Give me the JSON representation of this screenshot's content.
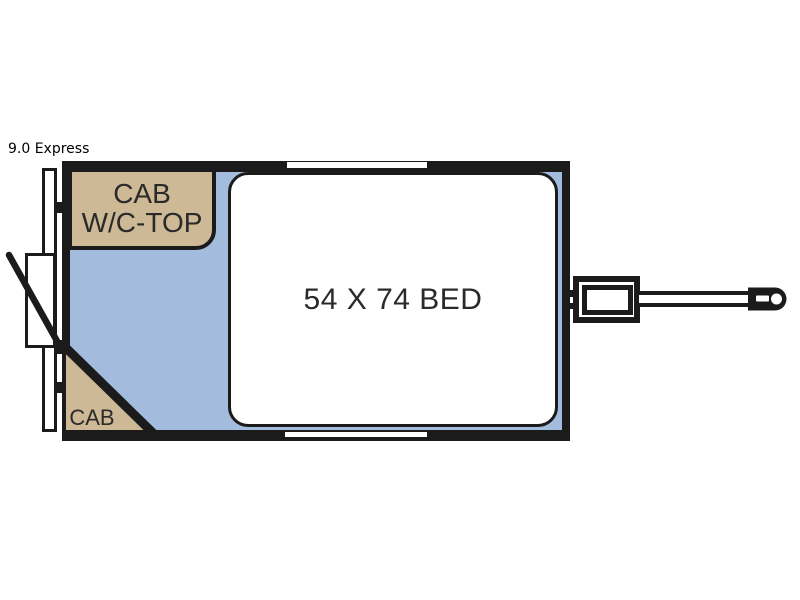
{
  "header": {
    "title": "9.0 Express"
  },
  "floorplan": {
    "bed": {
      "label": "54 X 74 BED"
    },
    "overhead_cabinet": {
      "label_line1": "CAB",
      "label_line2": "W/C-TOP"
    },
    "corner_cabinet": {
      "label": "CAB"
    },
    "colors": {
      "floor": "#A3BCDE",
      "cabinet": "#CDB995",
      "wall": "#1B1B1B",
      "bed_fill": "#FFFFFF",
      "label_text": "#2A2A2A",
      "background": "#FFFFFF"
    }
  }
}
